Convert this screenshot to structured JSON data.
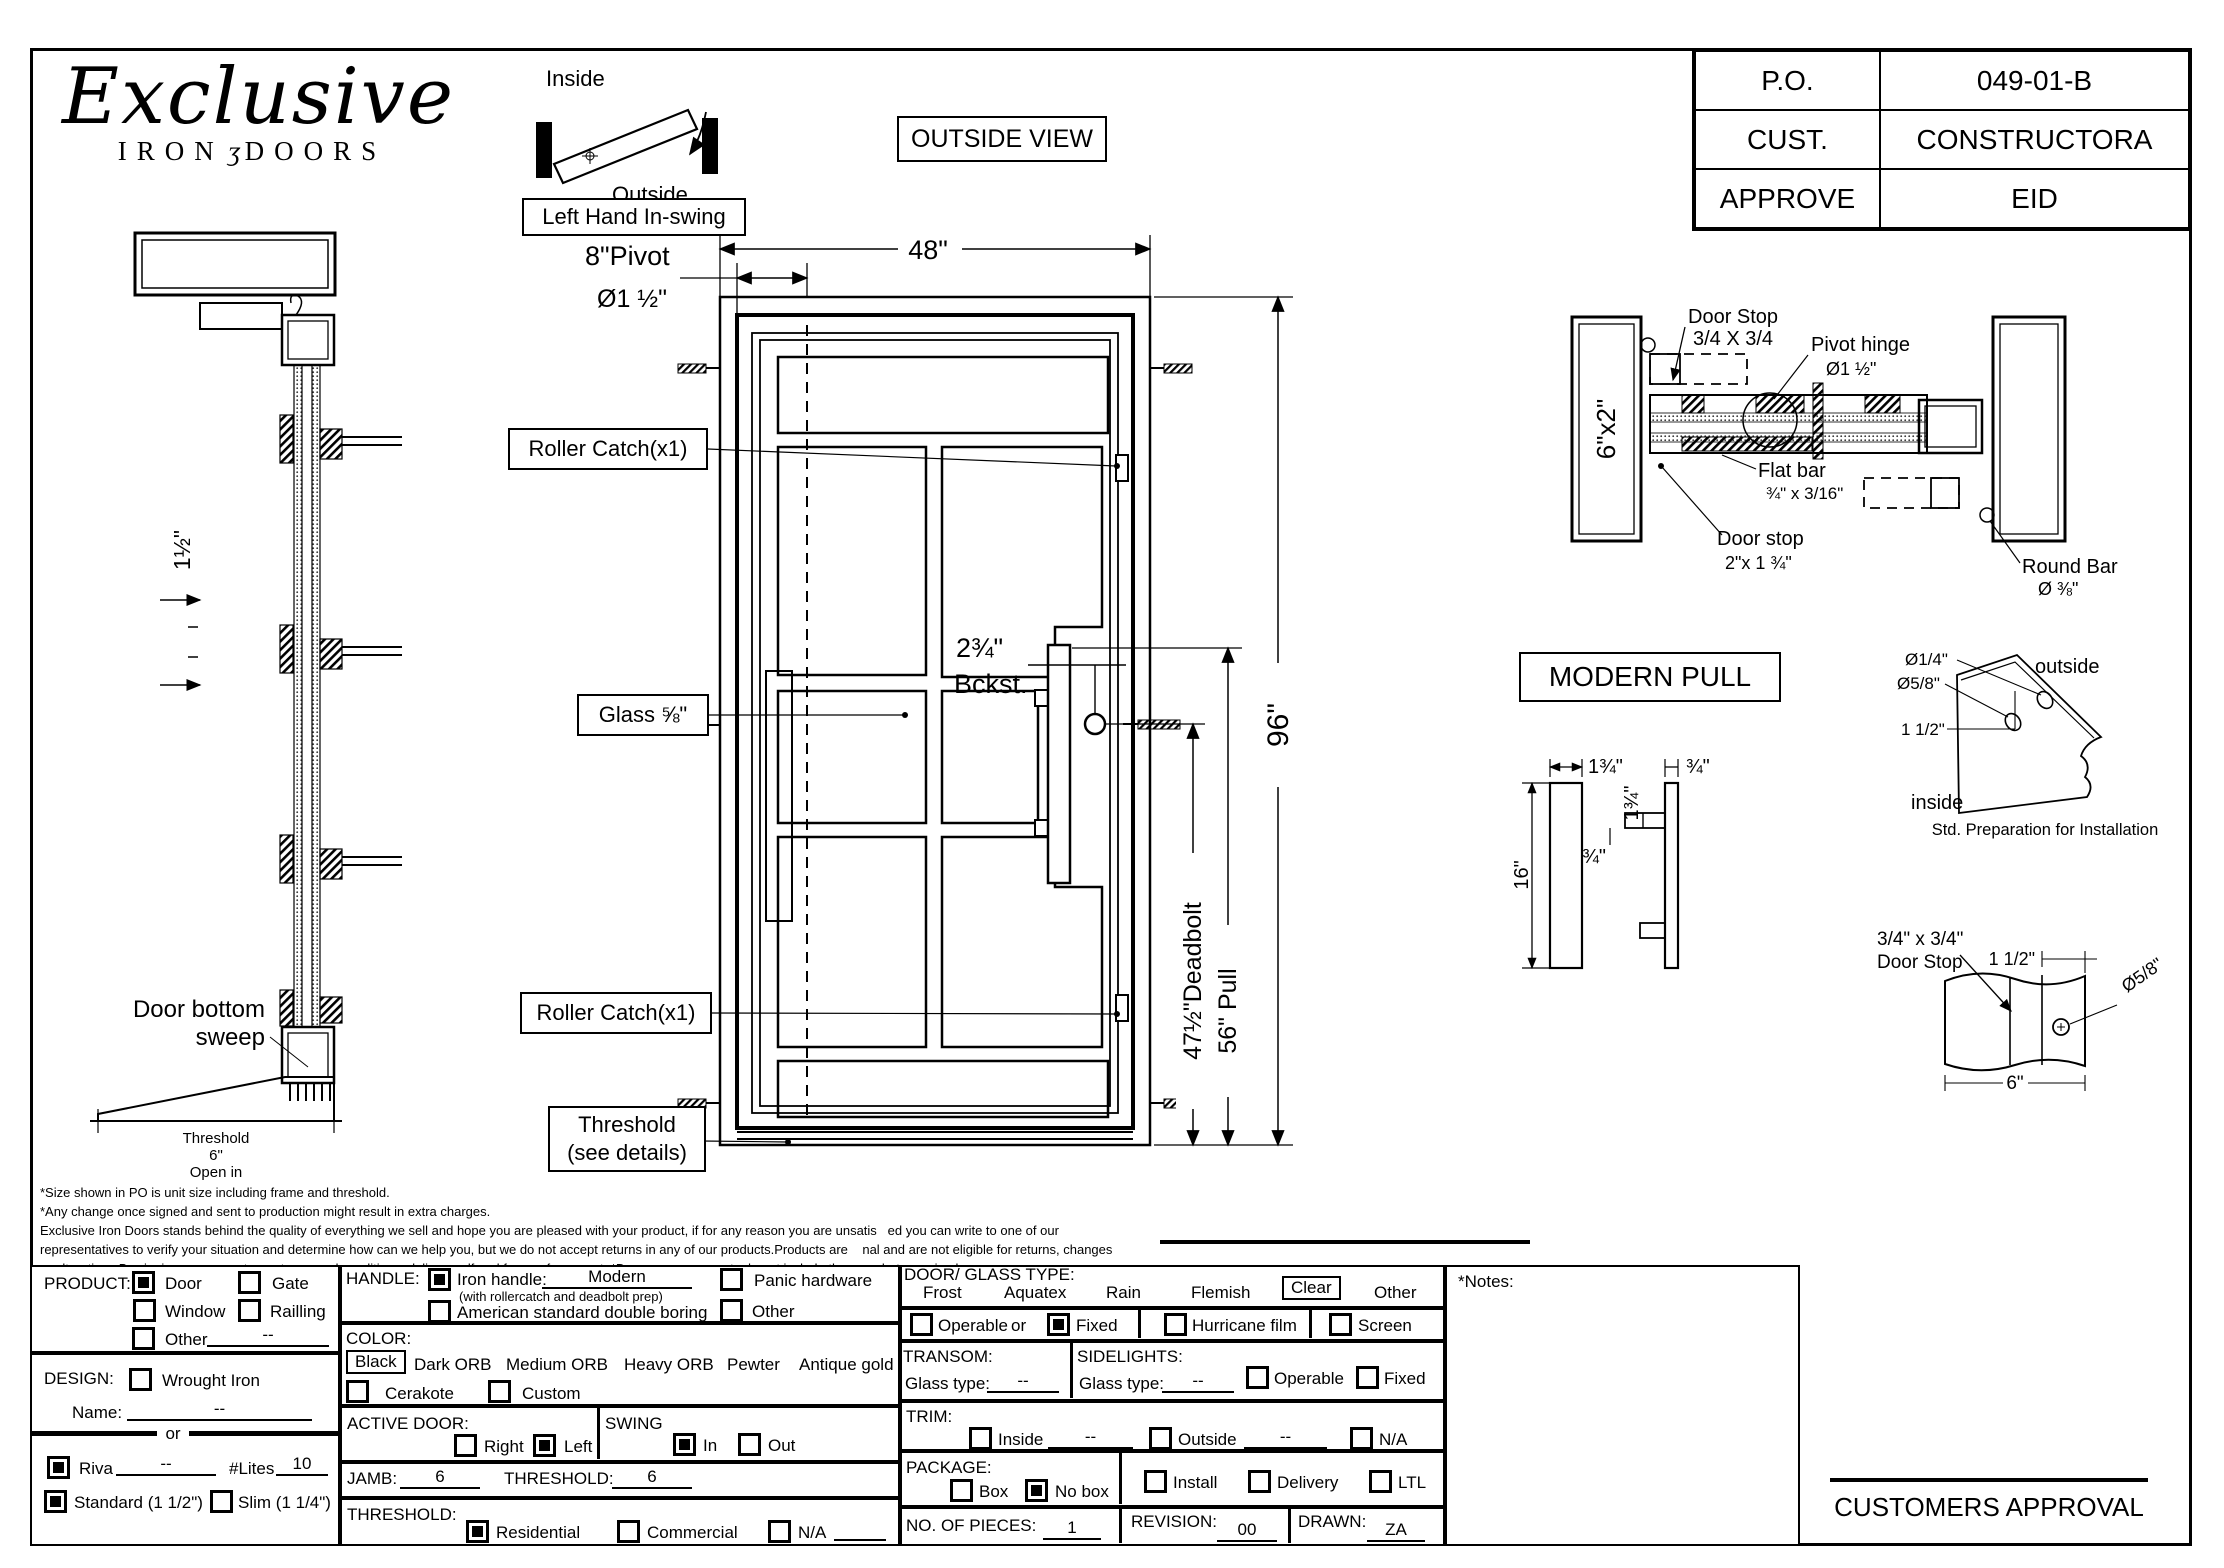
{
  "logo": {
    "script": "Exclusive",
    "iron": "IRON",
    "ornament": "ʒ",
    "doors": "DOORS"
  },
  "titleblock": {
    "rows": [
      {
        "label": "P.O.",
        "value": "049-01-B"
      },
      {
        "label": "CUST.",
        "value": "CONSTRUCTORA"
      },
      {
        "label": "APPROVE",
        "value": "EID"
      }
    ]
  },
  "swing": {
    "inside": "Inside",
    "outside": "Outside",
    "tag": "Left Hand In-swing"
  },
  "outside_view": "OUTSIDE VIEW",
  "door": {
    "w48": "48\"",
    "pivot8": "8\"Pivot",
    "pivot_dia": "Ø1 ½\"",
    "rc_top": "Roller Catch(x1)",
    "rc_bot": "Roller Catch(x1)",
    "glass": "Glass ⅝\"",
    "bckst1": "2¾\"",
    "bckst2": "Bckst.",
    "h96": "96\"",
    "deadbolt": "47½\"Deadbolt",
    "pull": "56\" Pull",
    "thr1": "Threshold",
    "thr2": "(see details)"
  },
  "jamb_section": {
    "dim": "1½\"",
    "sweep1": "Door bottom",
    "sweep2": "sweep",
    "t1": "Threshold",
    "t2": "6\"",
    "t3": "Open in"
  },
  "hinge": {
    "ds1": "Door Stop",
    "ds2": "3/4 X 3/4",
    "ph1": "Pivot hinge",
    "ph2": "Ø1 ½\"",
    "jamb": "6\"x2\"",
    "fb1": "Flat bar",
    "fb2": "¾\" x 3/16\"",
    "dstop1": "Door stop",
    "dstop2": "2\"x 1 ¾\"",
    "rb1": "Round Bar",
    "rb2": "Ø ⅜\""
  },
  "pull": {
    "title": "MODERN PULL",
    "d134a": "1¾\"",
    "d34a": "¾\"",
    "d134b": "1¾\"",
    "d34b": "¾\"",
    "d16": "16\""
  },
  "bracket": {
    "dia14": "Ø1/4\"",
    "dia58": "Ø5/8\"",
    "d112": "1 1/2\"",
    "outside": "outside",
    "inside": "inside",
    "caption": "Std. Preparation for Installation"
  },
  "stop": {
    "l1": "3/4\" x 3/4\"",
    "l2": "Door Stop",
    "d112": "1 1/2\"",
    "dia58": "Ø5/8\"",
    "d6": "6\""
  },
  "disclaimer": {
    "l1": "*Size shown in PO is unit size including frame and threshold.",
    "l2": "*Any change once signed and sent to production might result in extra charges.",
    "l3": "Exclusive Iron Doors stands behind the quality of everything we sell and hope you are pleased with your product, if for any reason you are unsatis   ed you can write to one of our",
    "l4": "representatives to verify your situation and determine how can we help you, but we do not accept returns in any of our products.Products are    nal and are not eligible for returns, changes",
    "l5": "or alterations.By signing you agree to our terms and conditions, delivery pdf and forms of payment. *Doors measurements do not include the gaps between jambs"
  },
  "form": {
    "product": {
      "label": "PRODUCT:",
      "door": "Door",
      "gate": "Gate",
      "window": "Window",
      "railling": "Railling",
      "other": "Other",
      "other_val": "--"
    },
    "design": {
      "label": "DESIGN:",
      "wrought": "Wrought Iron",
      "name": "Name:",
      "name_val": "--",
      "or": "or"
    },
    "riva": {
      "label": "Riva",
      "val": "--",
      "lites": "#Lites",
      "lites_val": "10",
      "standard": "Standard (1 1/2\")",
      "slim": "Slim (1 1/4\")"
    },
    "handle": {
      "label": "HANDLE:",
      "iron": "Iron handle:",
      "iron_val": "Modern",
      "iron_sub": "(with rollercatch and deadbolt prep)",
      "asd": "American standard double boring",
      "panic": "Panic hardware",
      "other": "Other"
    },
    "color": {
      "label": "COLOR:",
      "black": "Black",
      "darkorb": "Dark ORB",
      "medorb": "Medium ORB",
      "heavyorb": "Heavy ORB",
      "pewter": "Pewter",
      "antique": "Antique gold",
      "cerakote": "Cerakote",
      "custom": "Custom"
    },
    "active": {
      "label": "ACTIVE DOOR:",
      "right": "Right",
      "left": "Left"
    },
    "swing": {
      "label": "SWING",
      "in": "In",
      "out": "Out"
    },
    "jamb": {
      "label": "JAMB:",
      "val": "6",
      "t_label": "THRESHOLD:",
      "t_val": "6"
    },
    "threshold": {
      "label": "THRESHOLD:",
      "res": "Residential",
      "com": "Commercial",
      "na": "N/A"
    },
    "glass": {
      "label": "DOOR/ GLASS TYPE:",
      "frost": "Frost",
      "aquatex": "Aquatex",
      "rain": "Rain",
      "flemish": "Flemish",
      "clear": "Clear",
      "other": "Other"
    },
    "fixedrow": {
      "operable": "Operable",
      "or": "or",
      "fixed": "Fixed",
      "hurricane": "Hurricane film",
      "screen": "Screen"
    },
    "transom": {
      "label": "TRANSOM:",
      "glass_type": "Glass type:",
      "val": "--"
    },
    "sidelights": {
      "label": "SIDELIGHTS:",
      "glass_type": "Glass type:",
      "val": "--",
      "operable": "Operable",
      "fixed": "Fixed"
    },
    "trim": {
      "label": "TRIM:",
      "inside": "Inside",
      "inside_val": "--",
      "outside": "Outside",
      "outside_val": "--",
      "na": "N/A"
    },
    "package": {
      "label": "PACKAGE:",
      "box": "Box",
      "nobox": "No box",
      "install": "Install",
      "delivery": "Delivery",
      "ltl": "LTL"
    },
    "pieces": {
      "label": "NO. OF  PIECES:",
      "val": "1"
    },
    "revision": {
      "label": "REVISION:",
      "val": "00"
    },
    "drawn": {
      "label": "DRAWN:",
      "val": "ZA"
    },
    "notes": {
      "label": "*Notes:"
    }
  },
  "approval": {
    "label": "CUSTOMERS APPROVAL"
  }
}
